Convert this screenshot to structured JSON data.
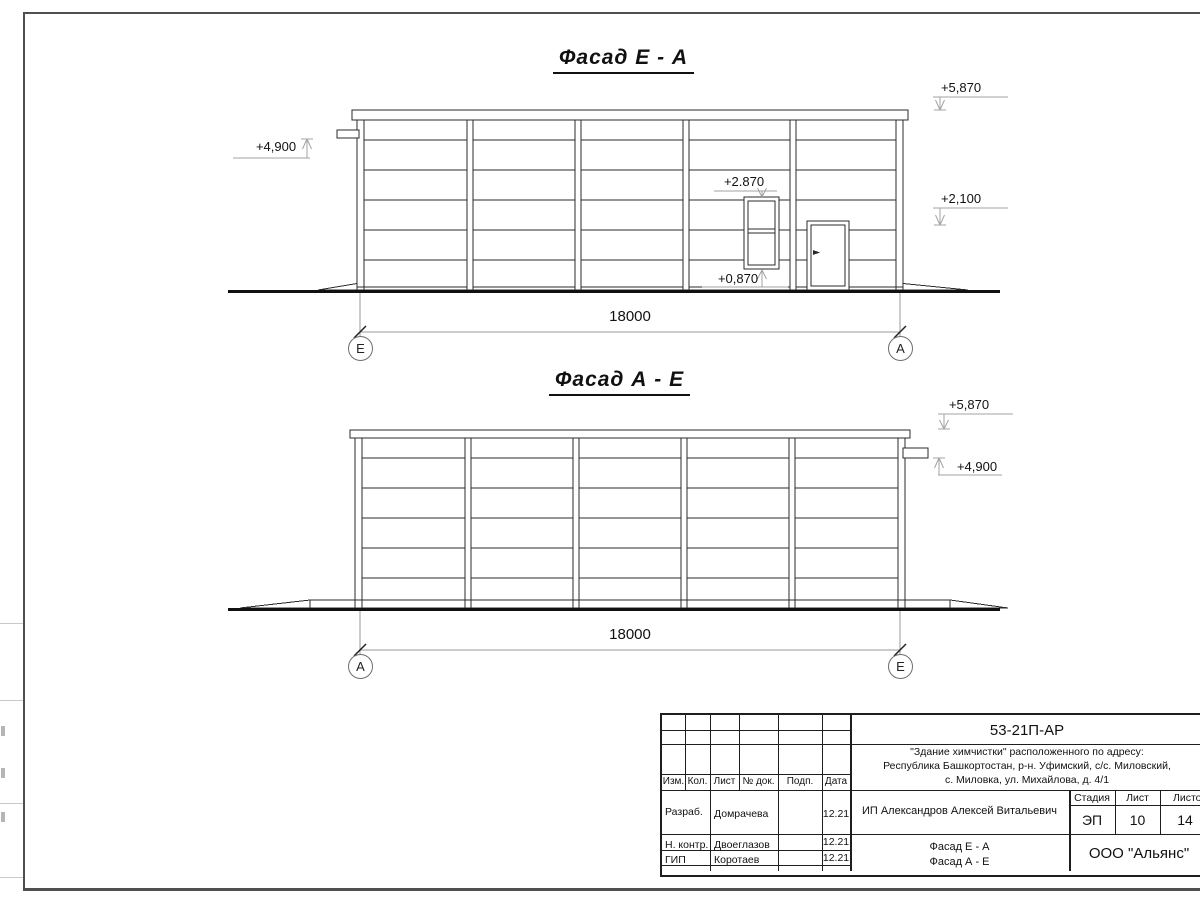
{
  "drawing": {
    "facade1": {
      "title": "Фасад Е - А",
      "dim": "18000",
      "axis_left": "Е",
      "axis_right": "А",
      "mark_roof": "+5,870",
      "mark_door": "+2,100",
      "mark_canopy": "+4,900",
      "mark_window_top": "+2.870",
      "mark_window_bottom": "+0,870"
    },
    "facade2": {
      "title": "Фасад А - Е",
      "dim": "18000",
      "axis_left": "А",
      "axis_right": "Е",
      "mark_roof": "+5,870",
      "mark_canopy": "+4,900"
    }
  },
  "title_block": {
    "doc_number": "53-21П-АР",
    "address_line1": "\"Здание химчистки\" расположенного по адресу:",
    "address_line2": "Республика Башкортостан, р-н. Уфимский, с/с. Миловский,",
    "address_line3": "с. Миловка, ул. Михайлова, д. 4/1",
    "client": "ИП Александров Алексей Витальевич",
    "sheet_title1": "Фасад Е - А",
    "sheet_title2": "Фасад А - Е",
    "company": "ООО \"Альянс\"",
    "col_izm": "Изм.",
    "col_kol": "Кол.",
    "col_list": "Лист",
    "col_doc": "№ док.",
    "col_podp": "Подп.",
    "col_data": "Дата",
    "stage_label": "Стадия",
    "stage_value": "ЭП",
    "sheet_label": "Лист",
    "sheet_value": "10",
    "total_label": "Листов",
    "total_value": "14",
    "rows": [
      {
        "role": "Разраб.",
        "name": "Домрачева",
        "date": "12.21"
      },
      {
        "role": "Н. контр.",
        "name": "Двоеглазов",
        "date": "12.21"
      },
      {
        "role": "ГИП",
        "name": "Коротаев",
        "date": "12.21"
      }
    ]
  }
}
